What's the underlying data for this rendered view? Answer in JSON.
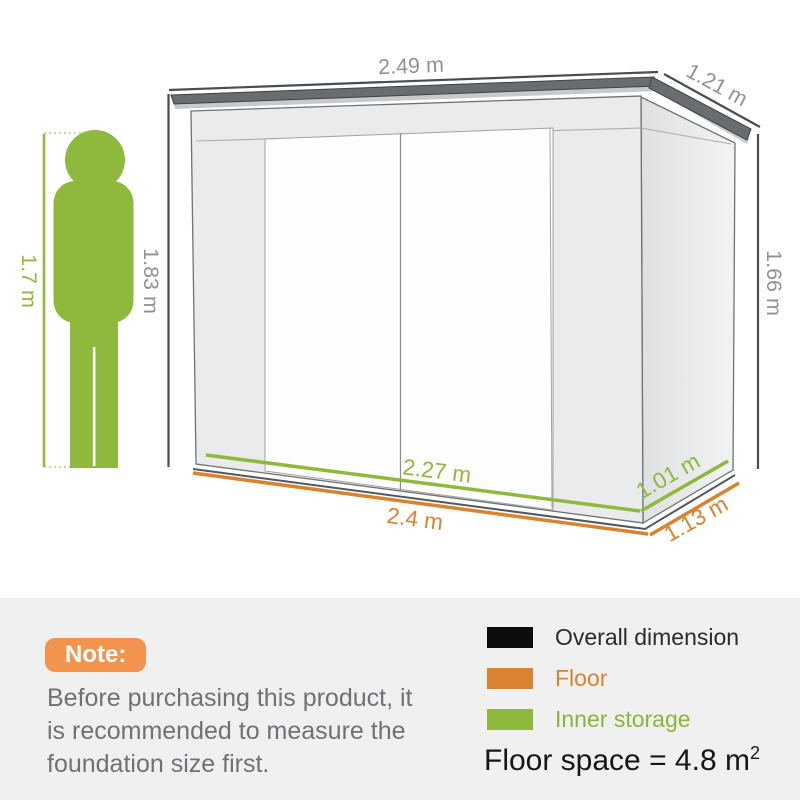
{
  "diagram": {
    "dim_labels": {
      "overall_width": "2.49 m",
      "overall_depth": "1.21 m",
      "overall_height_front": "1.83 m",
      "overall_height_rear": "1.66 m",
      "person_height": "1.7 m",
      "inner_width": "2.27 m",
      "inner_depth": "1.01 m",
      "floor_width": "2.4 m",
      "floor_depth": "1.13 m"
    },
    "colors": {
      "overall_dimension_lines": "#4a4d50",
      "floor_lines": "#d9822f",
      "inner_storage_lines": "#8eb93c",
      "person_figure": "#8eb93c",
      "dim_label_gray": "#909295"
    }
  },
  "note": {
    "badge_label": "Note:",
    "badge_color": "#f2944e",
    "line1": "Before purchasing this product, it",
    "line2": "is recommended to measure the",
    "line3": "foundation size first."
  },
  "legend": {
    "items": [
      {
        "label": "Overall dimension",
        "swatch_color": "#0c0c0c",
        "label_color": "#2b2b2b"
      },
      {
        "label": "Floor",
        "swatch_color": "#d9822f",
        "label_color": "#d9822f"
      },
      {
        "label": "Inner storage",
        "swatch_color": "#8eb93c",
        "label_color": "#8cb43c"
      }
    ],
    "floor_space_text": "Floor space = 4.8 m",
    "floor_space_sup": "2"
  }
}
